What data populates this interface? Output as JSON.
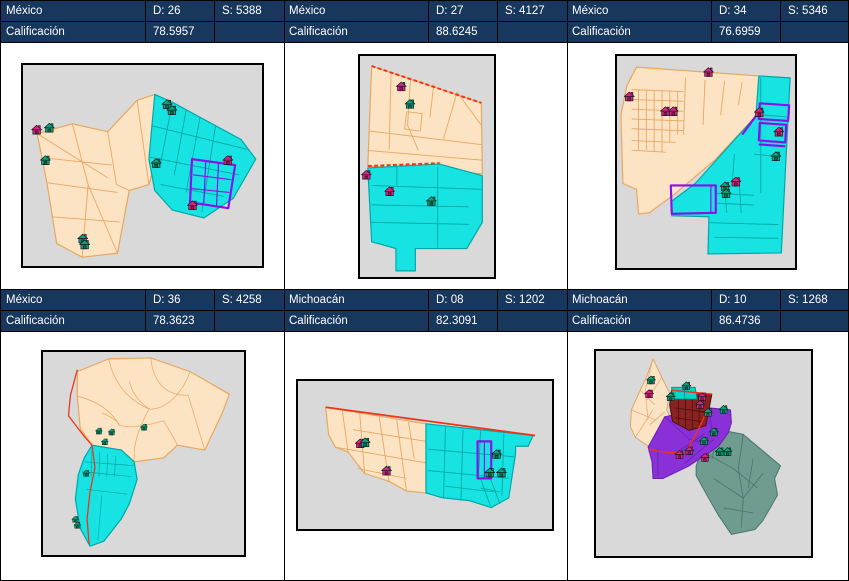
{
  "panels": [
    {
      "state": "México",
      "district": "D: 26",
      "section": "S: 5388",
      "score_label": "Calificación",
      "score": "78.5957"
    },
    {
      "state": "México",
      "district": "D: 27",
      "section": "S: 4127",
      "score_label": "Calificación",
      "score": "88.6245"
    },
    {
      "state": "México",
      "district": "D: 34",
      "section": "S: 5346",
      "score_label": "Calificación",
      "score": "76.6959"
    },
    {
      "state": "México",
      "district": "D: 36",
      "section": "S: 4258",
      "score_label": "Calificación",
      "score": "78.3623"
    },
    {
      "state": "Michoacán",
      "district": "D: 08",
      "section": "S: 1202",
      "score_label": "Calificación",
      "score": "82.3091"
    },
    {
      "state": "Michoacán",
      "district": "D: 10",
      "section": "S: 1268",
      "score_label": "Calificación",
      "score": "86.4736"
    }
  ],
  "colors": {
    "header_bg": "#17375D",
    "header_text": "#FFFFFF",
    "map_bg": "#D9D9D9",
    "parcel_tan": "#FBE3C3",
    "parcel_tan_stroke": "#E8A65F",
    "parcel_cyan": "#17E3E3",
    "parcel_cyan_stroke": "#00A6A6",
    "highlight_purple": "#8A10E8",
    "boundary_red": "#F03318",
    "house_magenta": "#E0218A",
    "house_teal": "#00A77C",
    "map6_maroon": "#8B2222",
    "map6_purple": "#8930D8",
    "map6_slate": "#6F9B91"
  },
  "icons": {
    "house": "house-icon"
  },
  "maps": {
    "map1": {
      "size": [
        11,
        10
      ],
      "items": [
        {
          "color": "magenta",
          "x": 8,
          "y": 61
        },
        {
          "color": "teal",
          "x": 21,
          "y": 59
        },
        {
          "color": "teal",
          "x": 17,
          "y": 92
        },
        {
          "color": "teal",
          "x": 141,
          "y": 35
        },
        {
          "color": "teal",
          "x": 146,
          "y": 41
        },
        {
          "color": "teal",
          "x": 130,
          "y": 95
        },
        {
          "color": "magenta",
          "x": 203,
          "y": 92
        },
        {
          "color": "magenta",
          "x": 167,
          "y": 138
        },
        {
          "color": "teal",
          "x": 55,
          "y": 172
        },
        {
          "color": "teal",
          "x": 57,
          "y": 178
        }
      ]
    },
    "map2": {
      "size": [
        11,
        10
      ],
      "items": [
        {
          "color": "magenta",
          "x": 37,
          "y": 25
        },
        {
          "color": "teal",
          "x": 46,
          "y": 43
        },
        {
          "color": "magenta",
          "x": 1,
          "y": 116
        },
        {
          "color": "magenta",
          "x": 25,
          "y": 133
        },
        {
          "color": "teal",
          "x": 68,
          "y": 143
        }
      ]
    },
    "map3": {
      "size": [
        11,
        10
      ],
      "items": [
        {
          "color": "magenta",
          "x": 88,
          "y": 11
        },
        {
          "color": "magenta",
          "x": 7,
          "y": 36
        },
        {
          "color": "magenta",
          "x": 44,
          "y": 51
        },
        {
          "color": "magenta",
          "x": 52,
          "y": 51
        },
        {
          "color": "magenta",
          "x": 140,
          "y": 52
        },
        {
          "color": "magenta",
          "x": 160,
          "y": 72
        },
        {
          "color": "teal",
          "x": 157,
          "y": 97
        },
        {
          "color": "magenta",
          "x": 116,
          "y": 123
        },
        {
          "color": "teal",
          "x": 105,
          "y": 128
        },
        {
          "color": "teal",
          "x": 106,
          "y": 135
        }
      ]
    },
    "map4": {
      "size": [
        8,
        7
      ],
      "items": [
        {
          "color": "teal",
          "x": 53,
          "y": 77
        },
        {
          "color": "teal",
          "x": 66,
          "y": 78
        },
        {
          "color": "teal",
          "x": 99,
          "y": 73
        },
        {
          "color": "teal",
          "x": 59,
          "y": 88
        },
        {
          "color": "teal",
          "x": 40,
          "y": 120
        },
        {
          "color": "teal",
          "x": 29,
          "y": 167
        },
        {
          "color": "teal",
          "x": 31,
          "y": 173
        }
      ]
    },
    "map5": {
      "size": [
        11,
        10
      ],
      "items": [
        {
          "color": "magenta",
          "x": 57,
          "y": 59
        },
        {
          "color": "teal",
          "x": 62,
          "y": 58
        },
        {
          "color": "magenta",
          "x": 84,
          "y": 87
        },
        {
          "color": "teal",
          "x": 197,
          "y": 70
        },
        {
          "color": "teal",
          "x": 190,
          "y": 89
        },
        {
          "color": "teal",
          "x": 202,
          "y": 89
        }
      ]
    },
    "map6": {
      "size": [
        10,
        9
      ],
      "items": [
        {
          "color": "teal",
          "x": 51,
          "y": 25
        },
        {
          "color": "magenta",
          "x": 49,
          "y": 39
        },
        {
          "color": "teal",
          "x": 87,
          "y": 31
        },
        {
          "color": "teal",
          "x": 71,
          "y": 42
        },
        {
          "color": "magenta",
          "x": 103,
          "y": 42
        },
        {
          "color": "magenta",
          "x": 101,
          "y": 50
        },
        {
          "color": "teal",
          "x": 109,
          "y": 58
        },
        {
          "color": "teal",
          "x": 125,
          "y": 55
        },
        {
          "color": "teal",
          "x": 115,
          "y": 78
        },
        {
          "color": "teal",
          "x": 105,
          "y": 87
        },
        {
          "color": "teal",
          "x": 121,
          "y": 98
        },
        {
          "color": "teal",
          "x": 129,
          "y": 98
        },
        {
          "color": "magenta",
          "x": 90,
          "y": 97
        },
        {
          "color": "magenta",
          "x": 80,
          "y": 101
        },
        {
          "color": "magenta",
          "x": 106,
          "y": 104
        }
      ]
    }
  }
}
